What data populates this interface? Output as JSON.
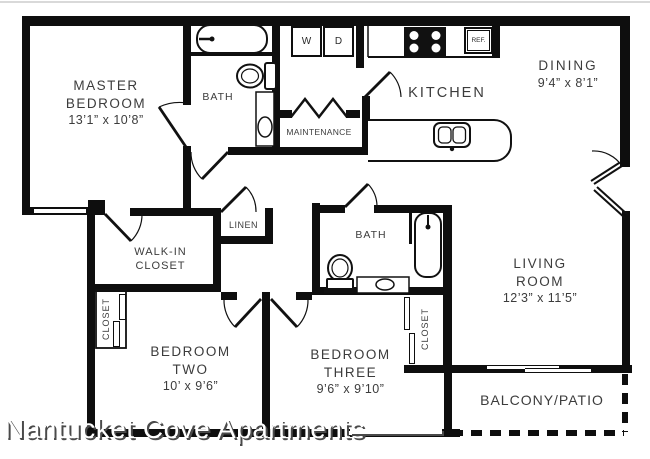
{
  "watermark": {
    "text": "Nantucket Cove Apartments"
  },
  "rooms": {
    "master": {
      "line1": "MASTER",
      "line2": "BEDROOM",
      "dims": "13’1” x 10’8”"
    },
    "bath1": {
      "label": "BATH"
    },
    "laundry": {
      "washer": "W",
      "dryer": "D"
    },
    "maintenance": {
      "label": "MAINTENANCE"
    },
    "kitchen": {
      "label": "KITCHEN"
    },
    "dining": {
      "label": "DINING",
      "dims": "9’4” x 8’1”"
    },
    "living": {
      "line1": "LIVING",
      "line2": "ROOM",
      "dims": "12’3” x 11’5”"
    },
    "walkin_closet": {
      "line1": "WALK-IN",
      "line2": "CLOSET"
    },
    "linen": {
      "label": "LINEN"
    },
    "bath2": {
      "label": "BATH"
    },
    "closet_br2": {
      "label": "CLOSET"
    },
    "closet_br3": {
      "label": "CLOSET"
    },
    "bedroom2": {
      "line1": "BEDROOM",
      "line2": "TWO",
      "dims": "10’ x 9’6”"
    },
    "bedroom3": {
      "line1": "BEDROOM",
      "line2": "THREE",
      "dims": "9’6” x 9’10”"
    },
    "balcony": {
      "label": "BALCONY/PATIO"
    }
  },
  "appliances": {
    "fridge": "REF.",
    "dishwasher": "D.W."
  },
  "colors": {
    "wall": "#0e0e0e",
    "text": "#3c3c3c",
    "background": "#ffffff"
  }
}
